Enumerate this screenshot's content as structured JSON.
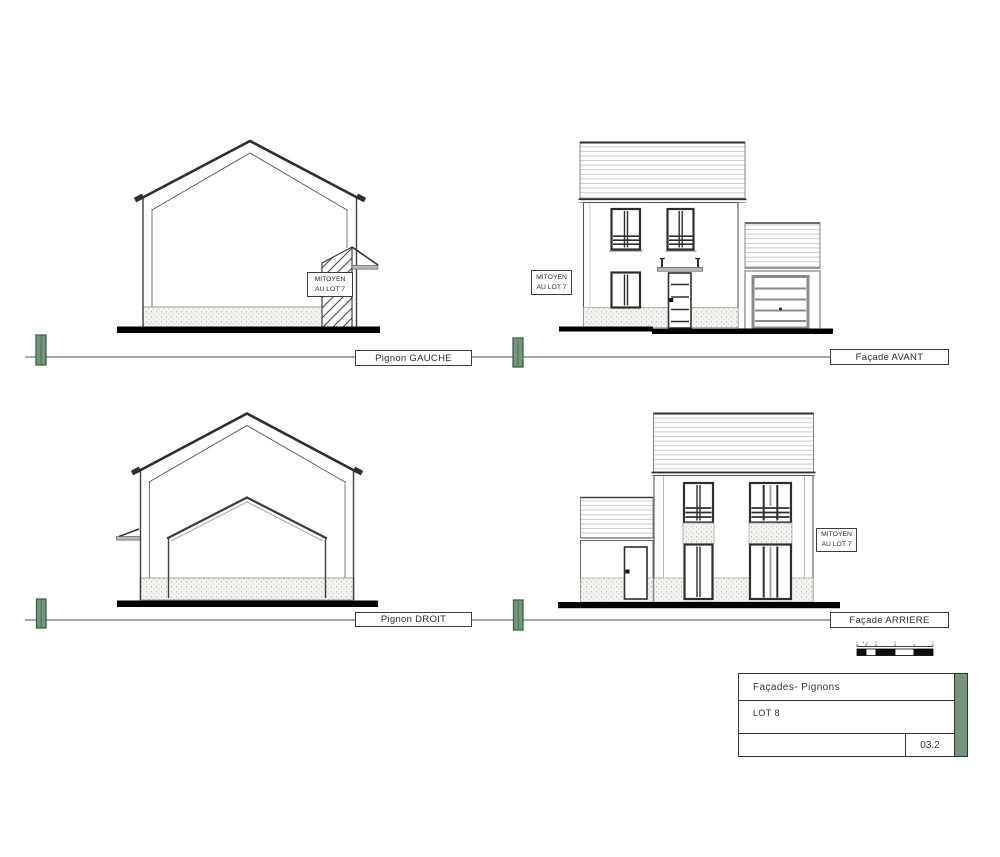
{
  "sheet": {
    "views": [
      {
        "id": "pignon-gauche",
        "label": "Pignon GAUCHE"
      },
      {
        "id": "facade-avant",
        "label": "Façade AVANT"
      },
      {
        "id": "pignon-droit",
        "label": "Pignon DROIT"
      },
      {
        "id": "facade-arriere",
        "label": "Façade ARRIERE"
      }
    ],
    "party_wall_note": {
      "line1": "MITOYEN",
      "line2": "AU LOT 7"
    },
    "title_block": {
      "project_title": "Façades- Pignons",
      "lot": "LOT 8",
      "sheet_number": "03.2"
    },
    "colors": {
      "post_green": "#74977b",
      "title_strip_green": "#74977b",
      "line_dark": "#2e2e2e",
      "ground_black": "#000000"
    }
  }
}
